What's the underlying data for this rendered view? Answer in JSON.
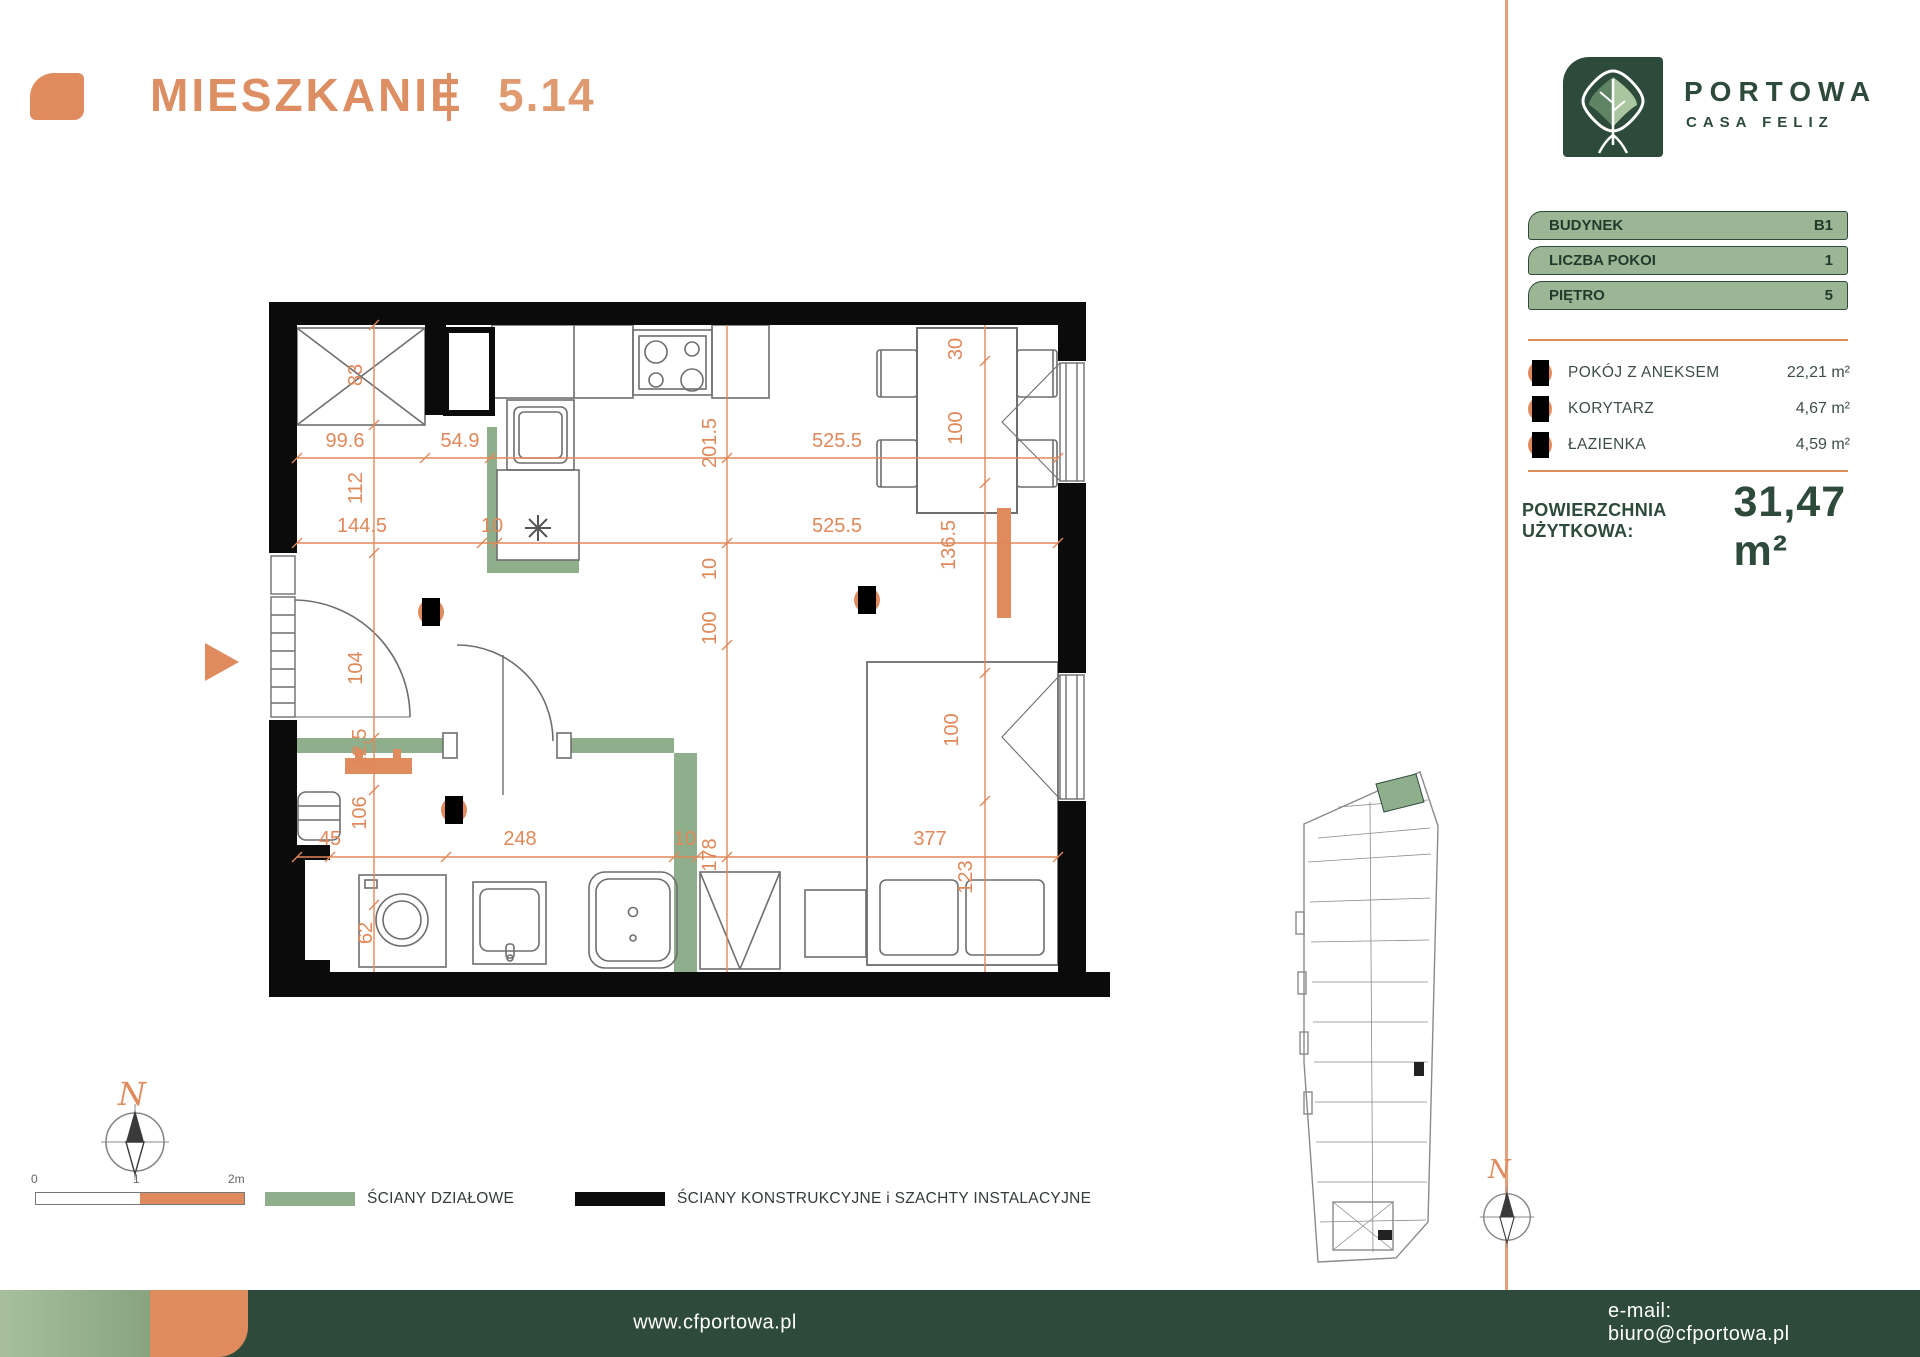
{
  "header": {
    "title": "MIESZKANIE",
    "number": "5.14"
  },
  "brand": {
    "name": "PORTOWA",
    "subtitle": "CASA FELIZ"
  },
  "info": [
    {
      "label": "BUDYNEK",
      "value": "B1"
    },
    {
      "label": "LICZBA POKOI",
      "value": "1"
    },
    {
      "label": "PIĘTRO",
      "value": "5"
    }
  ],
  "rooms": [
    {
      "name": "POKÓJ Z ANEKSEM",
      "area": "22,21 m²",
      "marker": {
        "x": 867,
        "y": 600
      }
    },
    {
      "name": "KORYTARZ",
      "area": "4,67 m²",
      "marker": {
        "x": 431,
        "y": 612
      }
    },
    {
      "name": "ŁAZIENKA",
      "area": "4,59 m²",
      "marker": {
        "x": 454,
        "y": 810
      }
    }
  ],
  "total": {
    "label": "POWIERZCHNIA UŻYTKOWA:",
    "value": "31,47 m²"
  },
  "plan": {
    "dims": [
      {
        "v": "83",
        "x": 362,
        "y": 375,
        "r": -90
      },
      {
        "v": "112",
        "x": 362,
        "y": 488,
        "r": -90
      },
      {
        "v": "104",
        "x": 362,
        "y": 668,
        "r": -90
      },
      {
        "v": "12,5",
        "x": 366,
        "y": 748,
        "r": -90
      },
      {
        "v": "106",
        "x": 366,
        "y": 813,
        "r": -90
      },
      {
        "v": "62",
        "x": 372,
        "y": 933,
        "r": -90
      },
      {
        "v": "99.6",
        "x": 345,
        "y": 447,
        "r": 0
      },
      {
        "v": "54.9",
        "x": 460,
        "y": 447,
        "r": 0
      },
      {
        "v": "525.5",
        "x": 837,
        "y": 447,
        "r": 0
      },
      {
        "v": "144.5",
        "x": 362,
        "y": 532,
        "r": 0
      },
      {
        "v": "10",
        "x": 492,
        "y": 532,
        "r": 0
      },
      {
        "v": "525.5",
        "x": 837,
        "y": 532,
        "r": 0
      },
      {
        "v": "201.5",
        "x": 716,
        "y": 443,
        "r": -90
      },
      {
        "v": "10",
        "x": 716,
        "y": 569,
        "r": -90
      },
      {
        "v": "100",
        "x": 716,
        "y": 628,
        "r": -90
      },
      {
        "v": "178",
        "x": 716,
        "y": 855,
        "r": -90
      },
      {
        "v": "45",
        "x": 330,
        "y": 845,
        "r": 0
      },
      {
        "v": "248",
        "x": 520,
        "y": 845,
        "r": 0
      },
      {
        "v": "10",
        "x": 685,
        "y": 845,
        "r": 0
      },
      {
        "v": "377",
        "x": 930,
        "y": 845,
        "r": 0
      },
      {
        "v": "30",
        "x": 962,
        "y": 349,
        "r": -90
      },
      {
        "v": "100",
        "x": 962,
        "y": 428,
        "r": -90
      },
      {
        "v": "136.5",
        "x": 955,
        "y": 545,
        "r": -90
      },
      {
        "v": "100",
        "x": 958,
        "y": 730,
        "r": -90
      },
      {
        "v": "123",
        "x": 972,
        "y": 877,
        "r": -90
      }
    ]
  },
  "legend": {
    "partition": {
      "label": "ŚCIANY DZIAŁOWE",
      "color": "#8FAE8B"
    },
    "structural": {
      "label": "ŚCIANY KONSTRUKCYJNE i SZACHTY INSTALACYJNE",
      "color": "#0B0B0B"
    }
  },
  "scalebar": {
    "labels": [
      "0",
      "1",
      "2m"
    ]
  },
  "compass": {
    "label": "N"
  },
  "footer": {
    "website": "www.cfportowa.pl",
    "email": "e-mail: biuro@cfportowa.pl"
  },
  "colors": {
    "accent_orange": "#DF8B5D",
    "dark_green": "#2D4A3B",
    "sage_green": "#9CB695"
  }
}
